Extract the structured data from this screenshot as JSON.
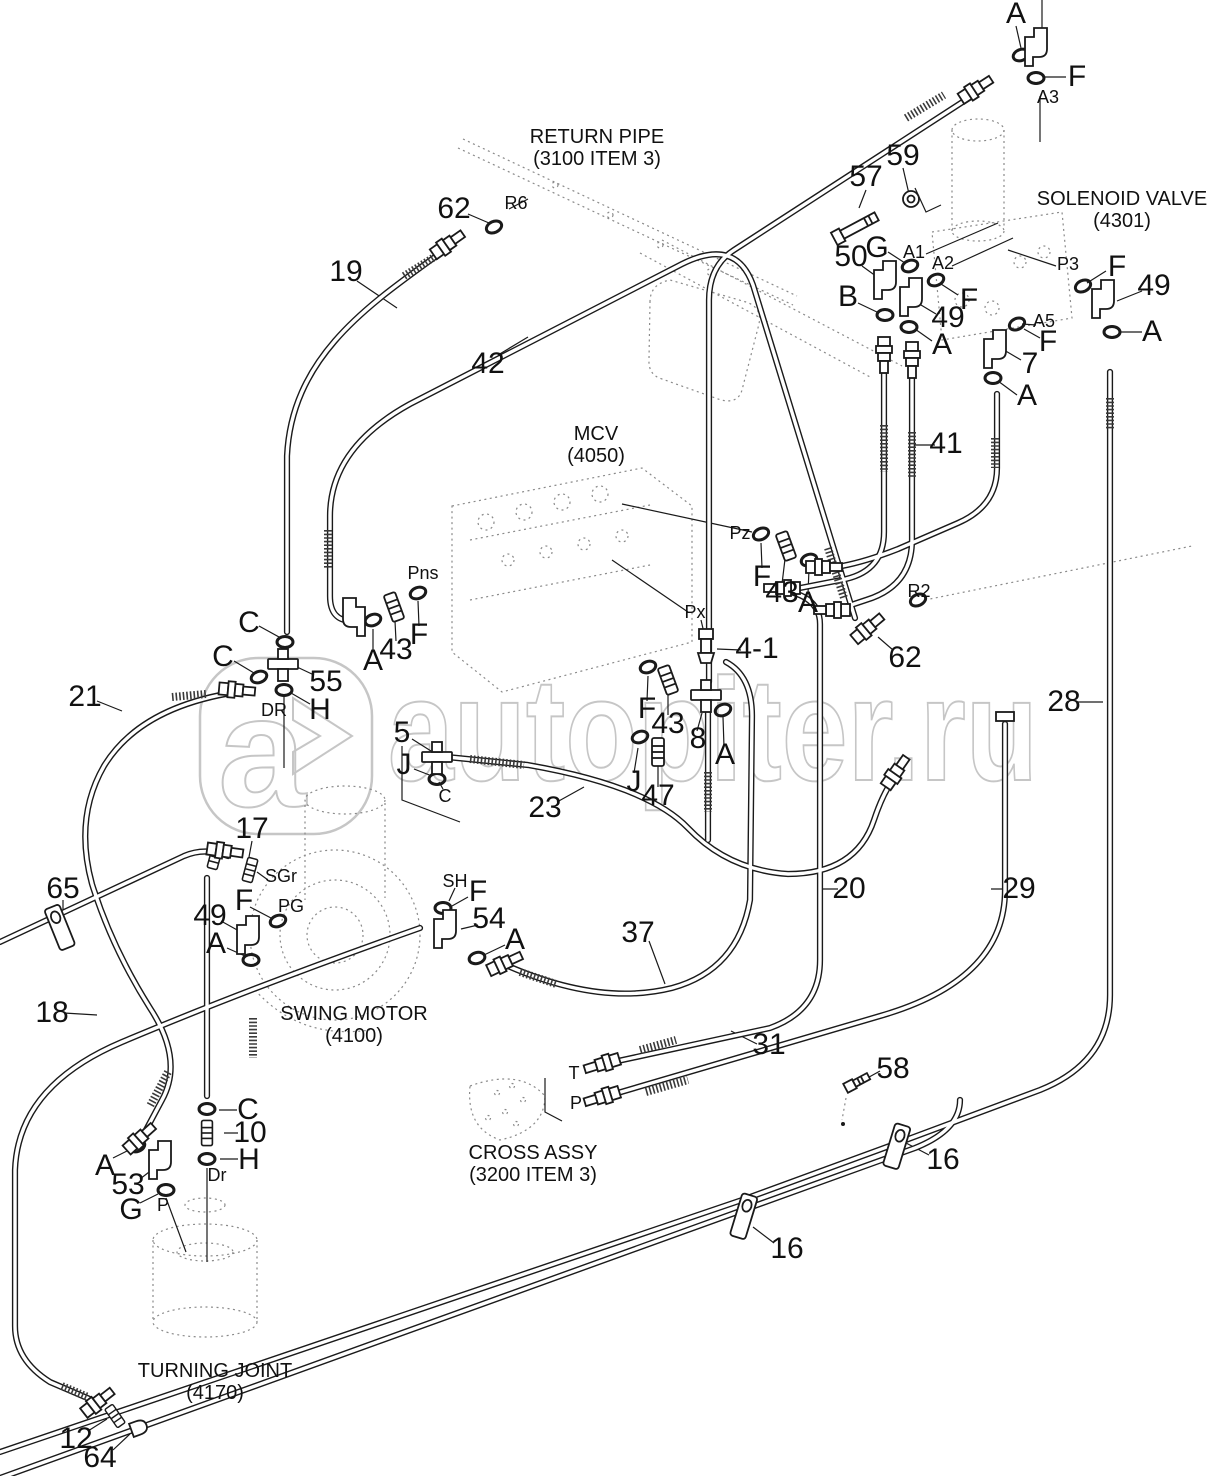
{
  "page": {
    "background": "#ffffff",
    "line_color": "#1a1a1a",
    "dotted_color": "#8a8a8a"
  },
  "watermark": {
    "text": "autopiter.ru",
    "logo_letter": "a",
    "color": "#c6c6c6"
  },
  "components": [
    {
      "id": "return-pipe",
      "name": "RETURN PIPE",
      "ref": "(3100 ITEM 3)",
      "x": 597,
      "y": 126
    },
    {
      "id": "solenoid-valve",
      "name": "SOLENOID VALVE",
      "ref": "(4301)",
      "x": 1122,
      "y": 188
    },
    {
      "id": "mcv",
      "name": "MCV",
      "ref": "(4050)",
      "x": 596,
      "y": 423
    },
    {
      "id": "swing-motor",
      "name": "SWING MOTOR",
      "ref": "(4100)",
      "x": 354,
      "y": 1003
    },
    {
      "id": "cross-assy",
      "name": "CROSS ASSY",
      "ref": "(3200 ITEM 3)",
      "x": 533,
      "y": 1142
    },
    {
      "id": "turning-joint",
      "name": "TURNING JOINT",
      "ref": "(4170)",
      "x": 215,
      "y": 1360
    }
  ],
  "callouts": [
    {
      "t": "A",
      "x": 1016,
      "y": 14,
      "k": "n"
    },
    {
      "t": "F",
      "x": 1077,
      "y": 77,
      "k": "n"
    },
    {
      "t": "A3",
      "x": 1048,
      "y": 97,
      "k": "p"
    },
    {
      "t": "62",
      "x": 454,
      "y": 209,
      "k": "n"
    },
    {
      "t": "R6",
      "x": 516,
      "y": 203,
      "k": "p"
    },
    {
      "t": "19",
      "x": 346,
      "y": 272,
      "k": "n"
    },
    {
      "t": "42",
      "x": 488,
      "y": 364,
      "k": "n"
    },
    {
      "t": "57",
      "x": 866,
      "y": 177,
      "k": "n"
    },
    {
      "t": "59",
      "x": 903,
      "y": 156,
      "k": "n"
    },
    {
      "t": "50",
      "x": 851,
      "y": 257,
      "k": "n"
    },
    {
      "t": "G",
      "x": 877,
      "y": 248,
      "k": "n"
    },
    {
      "t": "A1",
      "x": 914,
      "y": 252,
      "k": "p"
    },
    {
      "t": "A2",
      "x": 943,
      "y": 263,
      "k": "p"
    },
    {
      "t": "F",
      "x": 969,
      "y": 300,
      "k": "n"
    },
    {
      "t": "B",
      "x": 848,
      "y": 297,
      "k": "n"
    },
    {
      "t": "49",
      "x": 948,
      "y": 318,
      "k": "n"
    },
    {
      "t": "A",
      "x": 942,
      "y": 345,
      "k": "n"
    },
    {
      "t": "P3",
      "x": 1068,
      "y": 264,
      "k": "p"
    },
    {
      "t": "F",
      "x": 1117,
      "y": 267,
      "k": "n"
    },
    {
      "t": "49",
      "x": 1154,
      "y": 286,
      "k": "n"
    },
    {
      "t": "A5",
      "x": 1044,
      "y": 321,
      "k": "p"
    },
    {
      "t": "F",
      "x": 1048,
      "y": 342,
      "k": "n"
    },
    {
      "t": "7",
      "x": 1030,
      "y": 364,
      "k": "n"
    },
    {
      "t": "A",
      "x": 1152,
      "y": 332,
      "k": "n"
    },
    {
      "t": "A",
      "x": 1027,
      "y": 396,
      "k": "n"
    },
    {
      "t": "41",
      "x": 946,
      "y": 444,
      "k": "n"
    },
    {
      "t": "Pns",
      "x": 423,
      "y": 573,
      "k": "p"
    },
    {
      "t": "F",
      "x": 419,
      "y": 635,
      "k": "n"
    },
    {
      "t": "43",
      "x": 396,
      "y": 650,
      "k": "n"
    },
    {
      "t": "A",
      "x": 373,
      "y": 661,
      "k": "n"
    },
    {
      "t": "C",
      "x": 249,
      "y": 623,
      "k": "n"
    },
    {
      "t": "C",
      "x": 223,
      "y": 657,
      "k": "n"
    },
    {
      "t": "55",
      "x": 326,
      "y": 682,
      "k": "n"
    },
    {
      "t": "DR",
      "x": 274,
      "y": 710,
      "k": "p"
    },
    {
      "t": "H",
      "x": 320,
      "y": 710,
      "k": "n"
    },
    {
      "t": "21",
      "x": 85,
      "y": 697,
      "k": "n"
    },
    {
      "t": "Pz",
      "x": 740,
      "y": 533,
      "k": "p"
    },
    {
      "t": "F",
      "x": 762,
      "y": 577,
      "k": "n"
    },
    {
      "t": "43",
      "x": 782,
      "y": 593,
      "k": "n"
    },
    {
      "t": "A",
      "x": 808,
      "y": 603,
      "k": "n"
    },
    {
      "t": "R2",
      "x": 919,
      "y": 591,
      "k": "p"
    },
    {
      "t": "62",
      "x": 905,
      "y": 658,
      "k": "n"
    },
    {
      "t": "Px",
      "x": 695,
      "y": 612,
      "k": "p"
    },
    {
      "t": "4-1",
      "x": 757,
      "y": 649,
      "k": "n"
    },
    {
      "t": "28",
      "x": 1064,
      "y": 702,
      "k": "n"
    },
    {
      "t": "5",
      "x": 402,
      "y": 733,
      "k": "n"
    },
    {
      "t": "J",
      "x": 404,
      "y": 765,
      "k": "n"
    },
    {
      "t": "C",
      "x": 445,
      "y": 796,
      "k": "p"
    },
    {
      "t": "23",
      "x": 545,
      "y": 808,
      "k": "n"
    },
    {
      "t": "F",
      "x": 647,
      "y": 709,
      "k": "n"
    },
    {
      "t": "43",
      "x": 668,
      "y": 724,
      "k": "n"
    },
    {
      "t": "8",
      "x": 698,
      "y": 739,
      "k": "n"
    },
    {
      "t": "A",
      "x": 725,
      "y": 755,
      "k": "n"
    },
    {
      "t": "J",
      "x": 634,
      "y": 782,
      "k": "n"
    },
    {
      "t": "47",
      "x": 658,
      "y": 796,
      "k": "n"
    },
    {
      "t": "20",
      "x": 849,
      "y": 889,
      "k": "n"
    },
    {
      "t": "29",
      "x": 1019,
      "y": 889,
      "k": "n"
    },
    {
      "t": "17",
      "x": 252,
      "y": 829,
      "k": "n"
    },
    {
      "t": "65",
      "x": 63,
      "y": 889,
      "k": "n"
    },
    {
      "t": "SGr",
      "x": 281,
      "y": 876,
      "k": "p"
    },
    {
      "t": "F",
      "x": 244,
      "y": 901,
      "k": "n"
    },
    {
      "t": "PG",
      "x": 291,
      "y": 906,
      "k": "p"
    },
    {
      "t": "49",
      "x": 210,
      "y": 916,
      "k": "n"
    },
    {
      "t": "A",
      "x": 216,
      "y": 944,
      "k": "n"
    },
    {
      "t": "18",
      "x": 52,
      "y": 1013,
      "k": "n"
    },
    {
      "t": "SH",
      "x": 455,
      "y": 881,
      "k": "p"
    },
    {
      "t": "F",
      "x": 478,
      "y": 892,
      "k": "n"
    },
    {
      "t": "54",
      "x": 489,
      "y": 919,
      "k": "n"
    },
    {
      "t": "A",
      "x": 515,
      "y": 940,
      "k": "n"
    },
    {
      "t": "37",
      "x": 638,
      "y": 933,
      "k": "n"
    },
    {
      "t": "31",
      "x": 769,
      "y": 1045,
      "k": "n"
    },
    {
      "t": "T",
      "x": 574,
      "y": 1073,
      "k": "p"
    },
    {
      "t": "P",
      "x": 576,
      "y": 1103,
      "k": "p"
    },
    {
      "t": "58",
      "x": 893,
      "y": 1069,
      "k": "n"
    },
    {
      "t": "16",
      "x": 943,
      "y": 1160,
      "k": "n"
    },
    {
      "t": "16",
      "x": 787,
      "y": 1249,
      "k": "n"
    },
    {
      "t": "A",
      "x": 105,
      "y": 1166,
      "k": "n"
    },
    {
      "t": "53",
      "x": 128,
      "y": 1185,
      "k": "n"
    },
    {
      "t": "G",
      "x": 131,
      "y": 1210,
      "k": "n"
    },
    {
      "t": "P",
      "x": 163,
      "y": 1205,
      "k": "p"
    },
    {
      "t": "C",
      "x": 248,
      "y": 1110,
      "k": "n"
    },
    {
      "t": "10",
      "x": 250,
      "y": 1133,
      "k": "n"
    },
    {
      "t": "H",
      "x": 249,
      "y": 1160,
      "k": "n"
    },
    {
      "t": "Dr",
      "x": 217,
      "y": 1175,
      "k": "p"
    },
    {
      "t": "12",
      "x": 76,
      "y": 1439,
      "k": "n"
    },
    {
      "t": "64",
      "x": 100,
      "y": 1458,
      "k": "n"
    }
  ]
}
